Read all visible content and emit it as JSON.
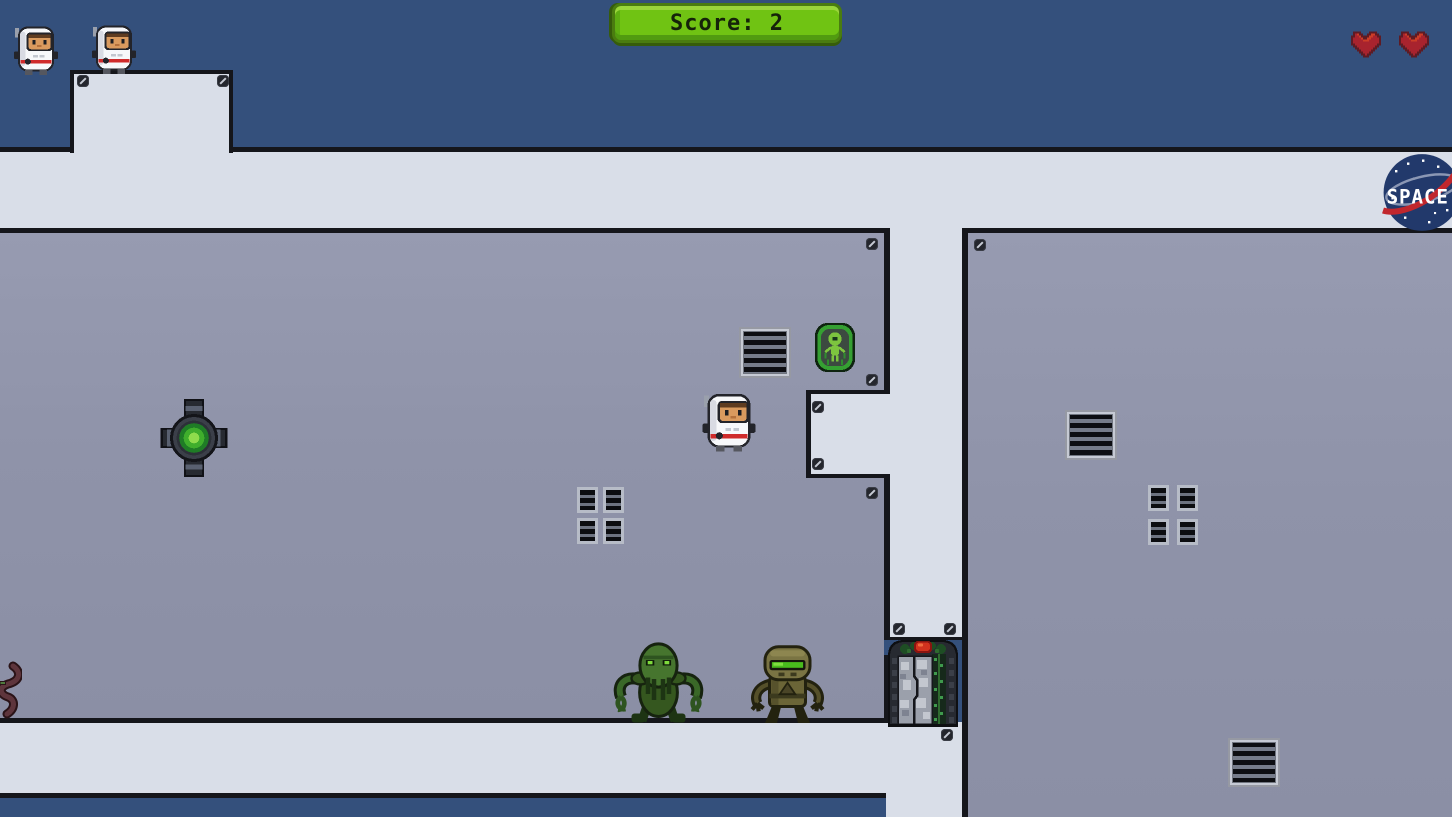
{
  "hud": {
    "score": {
      "label": "Score: 2",
      "value": 2
    },
    "lives_count": 2,
    "hearts_count": 2
  },
  "logo": {
    "text": "SPACE"
  },
  "icons": {
    "life": "astronaut-icon",
    "health": "heart-icon",
    "wall_fastener": "screw-icon",
    "air_vent": "vent-grill-icon",
    "hazard": "turret-mine-icon",
    "poster": "alien-shield-poster-icon",
    "exit": "sealed-door-icon",
    "brand": "space-agency-logo"
  },
  "colors": {
    "space_background": "#34507c",
    "corridor": "#d9dee8",
    "room_floor": "#8f93a9",
    "wall_outline": "#15161b",
    "score_badge_green": "#70c313",
    "score_badge_highlight": "#9ad53b",
    "heart_red": "#a8232e",
    "door_lamp_red": "#d2321e",
    "turret_glow_green": "#8edc4c",
    "logo_navy": "#22396b",
    "logo_swoosh_red": "#c1272d"
  }
}
